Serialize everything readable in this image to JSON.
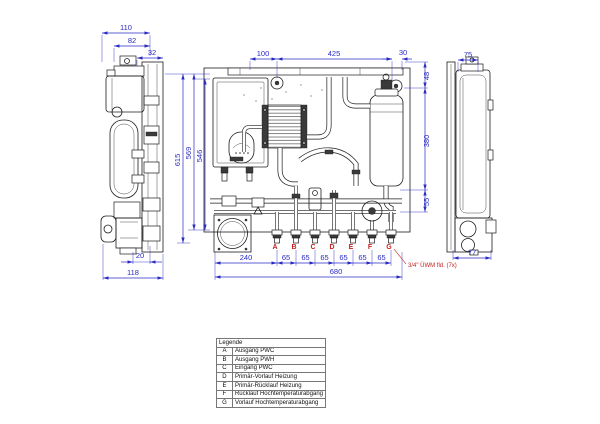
{
  "drawing": {
    "dim_color": "#2a2ac4",
    "line_color": "#1c1c1c",
    "accent_color": "#c51e1e"
  },
  "dimensions": {
    "left_view": {
      "width_total": "110",
      "width_inner": "82",
      "offset_top": "32",
      "offset_bottom": "20",
      "depth": "118"
    },
    "heights": {
      "total": "615",
      "upper": "569",
      "inner": "546"
    },
    "front_top": {
      "left": "100",
      "center": "425",
      "right": "30"
    },
    "right_column": {
      "top": "48",
      "middle": "380",
      "bottom": "55"
    },
    "right_view": {
      "top": "75",
      "bottom": "77"
    },
    "bottom": {
      "left": "240",
      "pitch": "65",
      "total": "680"
    }
  },
  "connections": {
    "labels": [
      "A",
      "B",
      "C",
      "D",
      "E",
      "F",
      "G"
    ],
    "note": "3/4\" ÜWM fld. (7x)"
  },
  "legend": {
    "title": "Legende",
    "rows": [
      {
        "key": "A",
        "label": "Ausgang PWC"
      },
      {
        "key": "B",
        "label": "Ausgang PWH"
      },
      {
        "key": "C",
        "label": "Eingang PWC"
      },
      {
        "key": "D",
        "label": "Primär-Vorlauf Heizung"
      },
      {
        "key": "E",
        "label": "Primär-Rücklauf Heizung"
      },
      {
        "key": "F",
        "label": "Rücklauf Hochtemperaturabgang"
      },
      {
        "key": "G",
        "label": "Vorlauf Hochtemperaturabgang"
      }
    ]
  }
}
